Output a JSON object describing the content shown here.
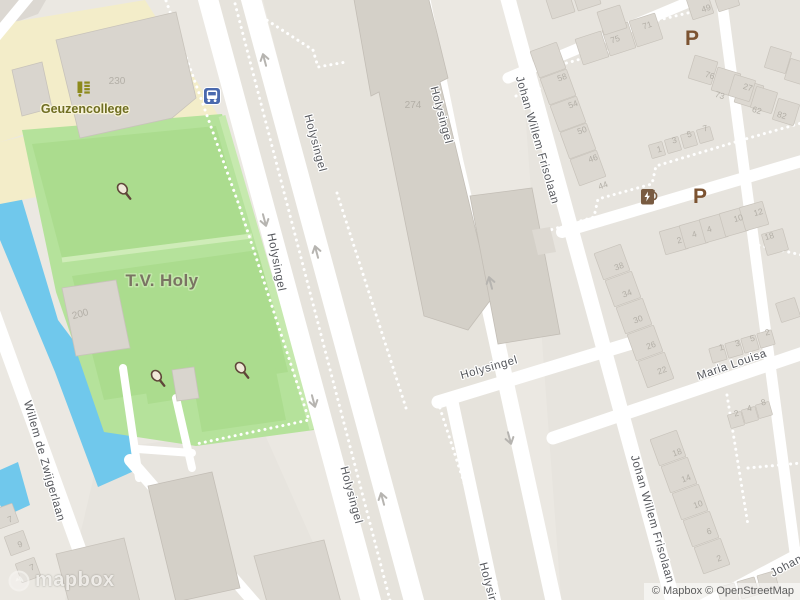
{
  "map": {
    "attribution": "© Mapbox © OpenStreetMap",
    "logo": "mapbox",
    "streets": {
      "holysingel": "Holysingel",
      "johan_willem_frisolaan": "Johan Willem Frisolaan",
      "willem_de_zwijgerlaan": "Willem de Zwijgerlaan",
      "maria_louisa": "Maria Louisa",
      "johan_partial": "Johan"
    },
    "pois": {
      "school": {
        "name": "Geuzencollege"
      },
      "tennis": {
        "name": "T.V. Holy"
      }
    },
    "colors": {
      "land": "#ebe8e2",
      "block": "#e6e3dc",
      "water": "#70c8ec",
      "park": "#b5e29b",
      "court": "#abdc8e",
      "court_line": "#cfecb8",
      "school_area": "#f3edc9",
      "building": "#d9d5ce",
      "road": "#ffffff",
      "street_label": "#55575c",
      "house_number": "#b3afa7",
      "school_label": "#6f6e22",
      "sport_label": "#7a7363",
      "parking": "#7c5331",
      "bus_icon": "#4a69ae",
      "ev_icon": "#795b41",
      "racket": "#5f4639"
    },
    "street_labels": [
      {
        "text": "Holysingel",
        "x": 312,
        "y": 144,
        "r": 75
      },
      {
        "text": "Holysingel",
        "x": 438,
        "y": 116,
        "r": 75
      },
      {
        "text": "Holysingel",
        "x": 273,
        "y": 263,
        "r": 79
      },
      {
        "text": "Holysingel",
        "x": 490,
        "y": 371,
        "r": -16
      },
      {
        "text": "Holysingel",
        "x": 348,
        "y": 496,
        "r": 75
      },
      {
        "text": "Holysingel",
        "x": 487,
        "y": 592,
        "r": 75
      },
      {
        "text": "Johan Willem Frisolaan",
        "x": 534,
        "y": 141,
        "r": 74
      },
      {
        "text": "Johan Willem Frisolaan",
        "x": 649,
        "y": 520,
        "r": 74
      },
      {
        "text": "Willem de Zwijgerlaan",
        "x": 41,
        "y": 462,
        "r": 74
      },
      {
        "text": "Maria Louisa",
        "x": 733,
        "y": 368,
        "r": -19
      },
      {
        "text": "Johan",
        "x": 788,
        "y": 569,
        "r": -28
      }
    ],
    "house_numbers": [
      [
        "230",
        117,
        84,
        0,
        1
      ],
      [
        "274",
        413,
        108,
        0,
        1
      ],
      [
        "200",
        81,
        317,
        -15,
        1
      ],
      [
        "75",
        616,
        42,
        -18,
        0
      ],
      [
        "71",
        648,
        28,
        -18,
        0
      ],
      [
        "49",
        707,
        11,
        -18,
        0
      ],
      [
        "58",
        563,
        80,
        -20,
        0
      ],
      [
        "54",
        574,
        107,
        -20,
        0
      ],
      [
        "50",
        583,
        133,
        -20,
        0
      ],
      [
        "46",
        594,
        161,
        -20,
        0
      ],
      [
        "44",
        604,
        188,
        -20,
        0
      ],
      [
        "76",
        709,
        78,
        17,
        0
      ],
      [
        "73",
        719,
        98,
        17,
        0
      ],
      [
        "27",
        747,
        90,
        17,
        0
      ],
      [
        "62",
        756,
        113,
        17,
        0
      ],
      [
        "82",
        781,
        118,
        17,
        0
      ],
      [
        "1",
        660,
        152,
        -16,
        0
      ],
      [
        "3",
        675,
        143,
        -16,
        0
      ],
      [
        "5",
        690,
        137,
        -16,
        0
      ],
      [
        "7",
        706,
        131,
        -16,
        0
      ],
      [
        "2",
        680,
        243,
        -16,
        0
      ],
      [
        "4",
        695,
        237,
        -16,
        0
      ],
      [
        "4",
        710,
        232,
        -16,
        0
      ],
      [
        "10",
        739,
        221,
        -16,
        0
      ],
      [
        "12",
        759,
        215,
        -16,
        0
      ],
      [
        "18",
        770,
        239,
        -16,
        0
      ],
      [
        "38",
        620,
        269,
        -20,
        0
      ],
      [
        "34",
        628,
        296,
        -20,
        0
      ],
      [
        "30",
        639,
        322,
        -20,
        0
      ],
      [
        "26",
        652,
        348,
        -20,
        0
      ],
      [
        "22",
        663,
        373,
        -20,
        0
      ],
      [
        "1",
        722,
        350,
        -14,
        0
      ],
      [
        "3",
        738,
        346,
        -14,
        0
      ],
      [
        "5",
        753,
        341,
        -14,
        0
      ],
      [
        "2",
        768,
        335,
        -14,
        0
      ],
      [
        "18",
        678,
        455,
        -20,
        0
      ],
      [
        "14",
        687,
        481,
        -20,
        0
      ],
      [
        "10",
        699,
        507,
        -20,
        0
      ],
      [
        "6",
        710,
        534,
        -20,
        0
      ],
      [
        "2",
        720,
        561,
        -20,
        0
      ],
      [
        "2",
        737,
        416,
        -14,
        0
      ],
      [
        "4",
        750,
        411,
        -14,
        0
      ],
      [
        "8",
        764,
        405,
        -14,
        0
      ],
      [
        "7",
        11,
        522,
        -20,
        0
      ],
      [
        "9",
        21,
        547,
        -20,
        0
      ],
      [
        "7",
        33,
        570,
        -20,
        0
      ]
    ],
    "house_chains": [
      [
        548,
        60,
        5,
        10,
        27,
        28,
        -20
      ],
      [
        592,
        48,
        3,
        27,
        -9,
        27,
        -18
      ],
      [
        612,
        20,
        1,
        0,
        0,
        24,
        -18
      ],
      [
        700,
        6,
        2,
        26,
        -8,
        22,
        -18
      ],
      [
        560,
        4,
        2,
        26,
        -8,
        24,
        -18
      ],
      [
        703,
        70,
        3,
        23,
        12,
        24,
        17
      ],
      [
        742,
        88,
        3,
        22,
        12,
        22,
        17
      ],
      [
        657,
        150,
        4,
        16,
        -5,
        14,
        -16
      ],
      [
        674,
        240,
        5,
        20,
        -6,
        24,
        -16
      ],
      [
        775,
        242,
        1,
        0,
        0,
        22,
        -16
      ],
      [
        612,
        262,
        5,
        11,
        27,
        28,
        -20
      ],
      [
        718,
        354,
        4,
        16,
        -5,
        15,
        -16
      ],
      [
        668,
        448,
        5,
        11,
        27,
        28,
        -20
      ],
      [
        736,
        420,
        3,
        14,
        -5,
        14,
        -16
      ],
      [
        788,
        310,
        1,
        0,
        0,
        20,
        -18
      ],
      [
        6,
        516,
        3,
        11,
        27,
        20,
        -20
      ],
      [
        728,
        594,
        3,
        20,
        -6,
        18,
        -16
      ],
      [
        778,
        60,
        2,
        20,
        12,
        22,
        17
      ]
    ],
    "arrows": [
      [
        264,
        58,
        -15
      ],
      [
        265,
        222,
        165
      ],
      [
        316,
        250,
        -15
      ],
      [
        314,
        403,
        165
      ],
      [
        382,
        497,
        -15
      ],
      [
        510,
        440,
        165
      ],
      [
        490,
        281,
        -15
      ]
    ],
    "icons": {
      "parking_label": "P",
      "parking": [
        [
          692,
          38
        ],
        [
          700,
          196
        ]
      ],
      "bus": {
        "x": 212,
        "y": 96
      },
      "ev": {
        "x": 648,
        "y": 197
      },
      "rackets": [
        [
          125,
          192
        ],
        [
          159,
          379
        ],
        [
          243,
          371
        ]
      ],
      "school_icon": {
        "x": 84,
        "y": 89
      }
    }
  }
}
